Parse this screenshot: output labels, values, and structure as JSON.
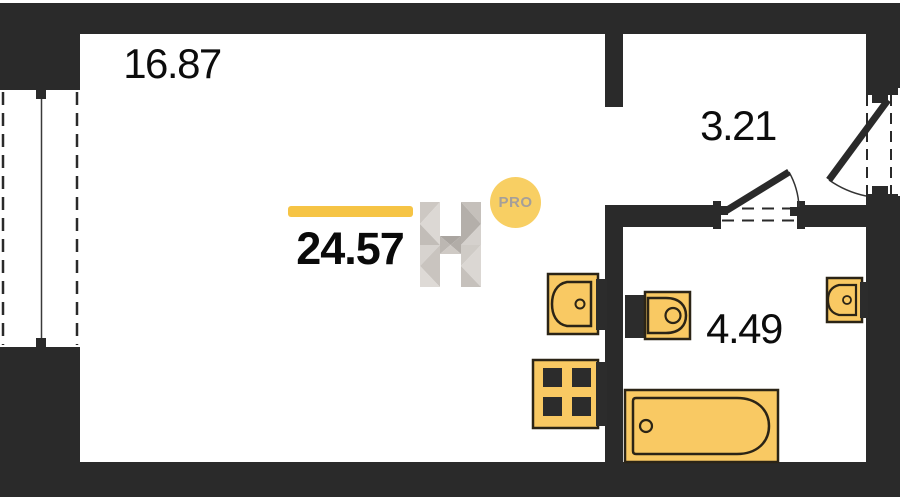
{
  "plan": {
    "title": "studio-apartment-floor-plan",
    "total": {
      "area": "24.57"
    },
    "rooms": [
      {
        "id": "living-room",
        "area": "16.87"
      },
      {
        "id": "hallway",
        "area": "3.21"
      },
      {
        "id": "bathroom",
        "area": "4.49"
      }
    ],
    "watermark": {
      "logo_letter": "H",
      "badge": "PRO"
    },
    "fixtures": [
      "kitchen-sink",
      "stove",
      "toilet",
      "wash-basin",
      "bathtub"
    ],
    "colors": {
      "wall": "#2a2a2a",
      "fixture_fill": "#f9c963",
      "fixture_stroke": "#2b2416",
      "accent_bar": "#f6c445",
      "badge_bg": "#f8cf63",
      "badge_text": "#a59f99"
    }
  }
}
